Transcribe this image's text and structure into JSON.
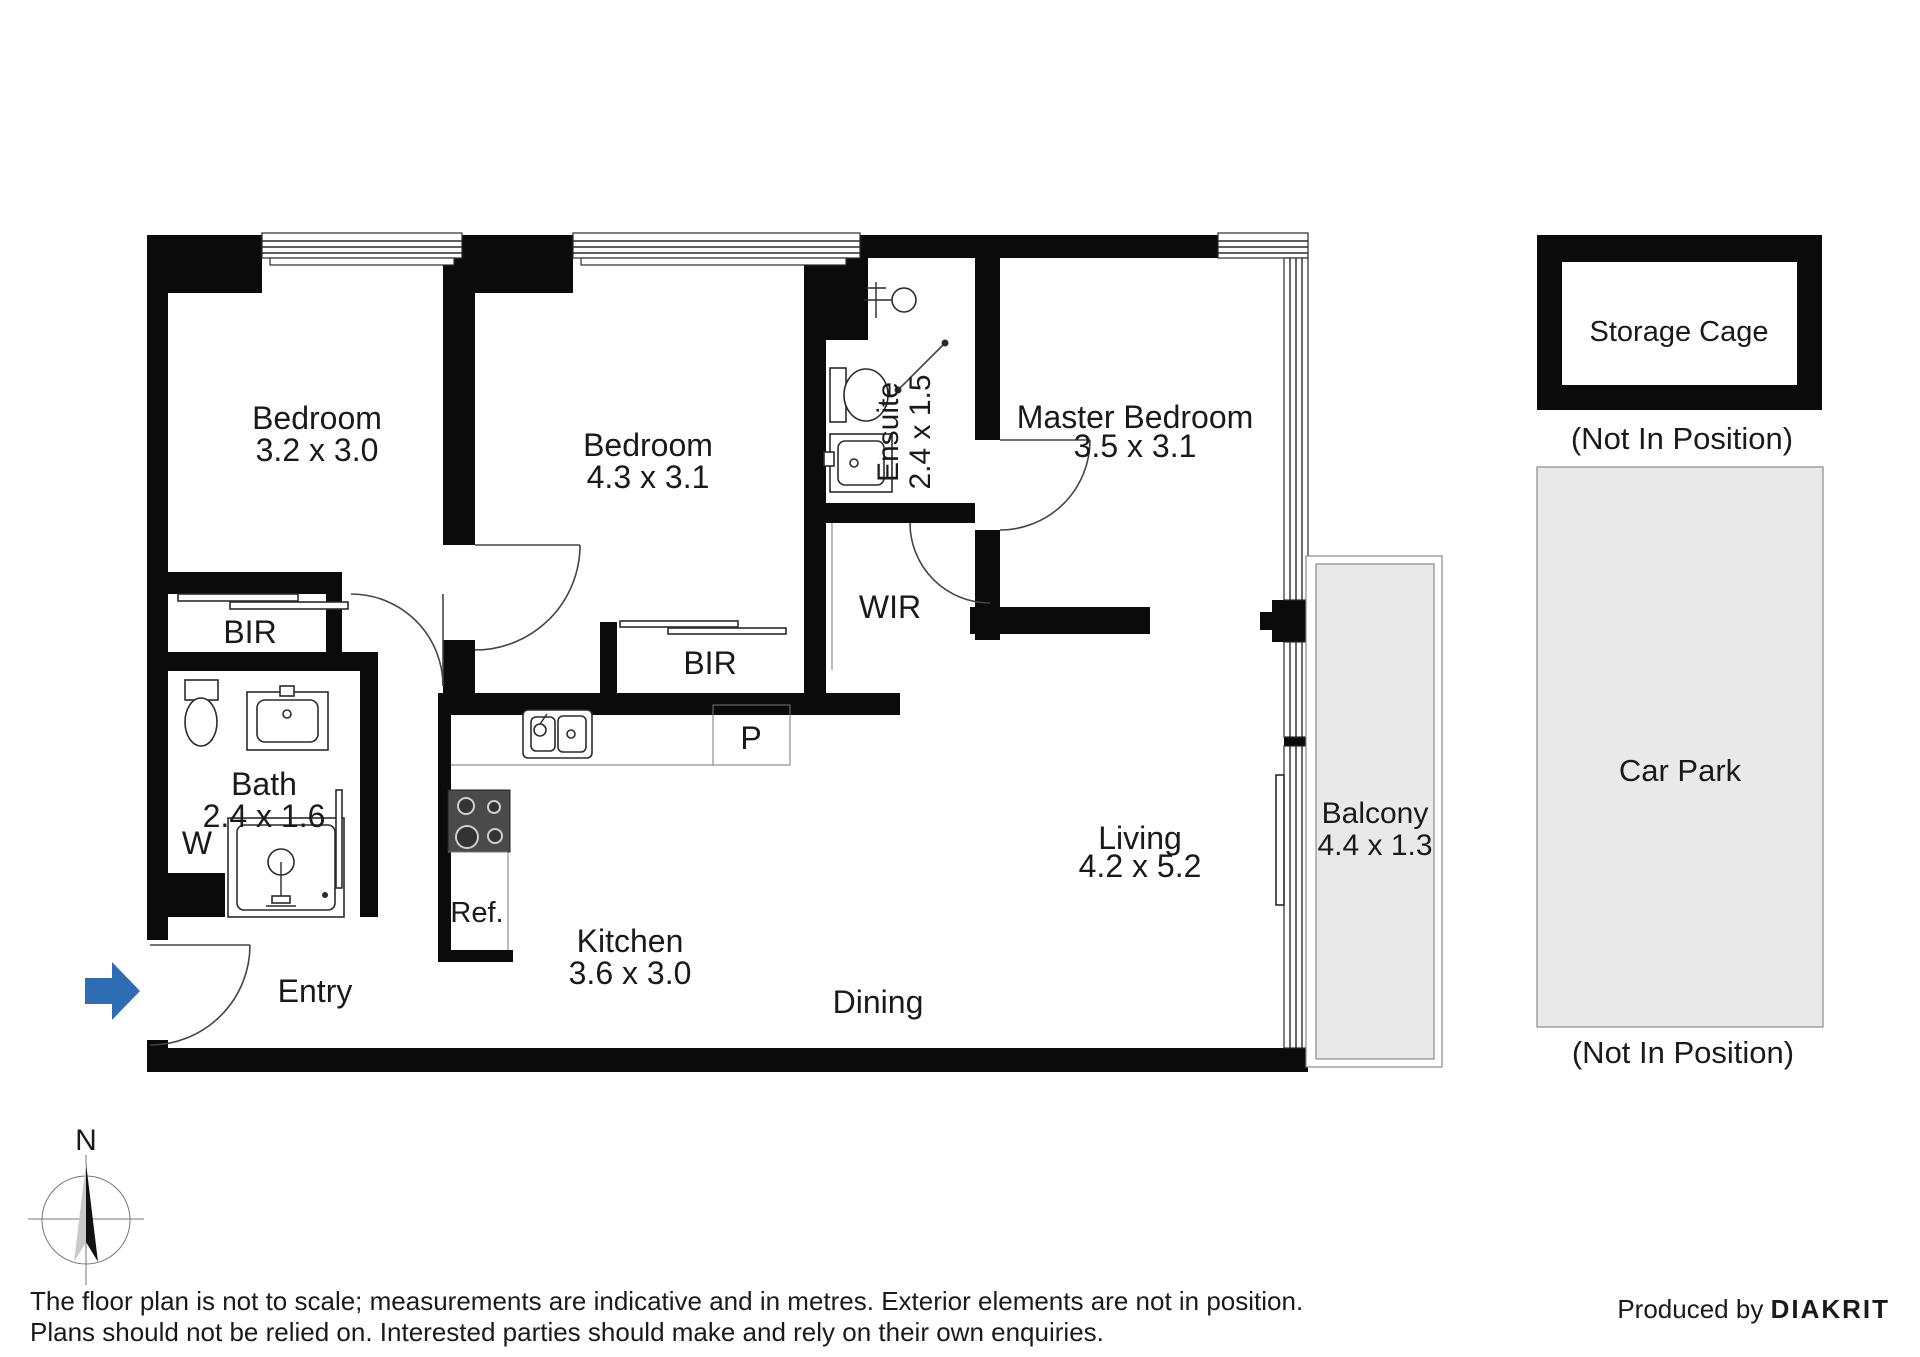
{
  "floorplan": {
    "rooms": {
      "bedroom1": {
        "name": "Bedroom",
        "dims": "3.2 x 3.0"
      },
      "bedroom2": {
        "name": "Bedroom",
        "dims": "4.3 x 3.1"
      },
      "master": {
        "name": "Master Bedroom",
        "dims": "3.5 x 3.1"
      },
      "ensuite": {
        "name": "Ensuite",
        "dims": "2.4 x 1.5"
      },
      "bath": {
        "name": "Bath",
        "dims": "2.4 x 1.6"
      },
      "kitchen": {
        "name": "Kitchen",
        "dims": "3.6 x 3.0"
      },
      "living": {
        "name": "Living",
        "dims": "4.2 x 5.2"
      },
      "balcony": {
        "name": "Balcony",
        "dims": "4.4 x 1.3"
      },
      "dining": {
        "name": "Dining"
      },
      "entry": {
        "name": "Entry"
      },
      "wir": {
        "name": "WIR"
      },
      "bir1": {
        "name": "BIR"
      },
      "bir2": {
        "name": "BIR"
      },
      "laundry": {
        "name": "W"
      },
      "pantry": {
        "name": "P"
      },
      "fridge": {
        "name": "Ref."
      }
    },
    "external": {
      "storage": {
        "name": "Storage Cage",
        "note": "(Not In Position)"
      },
      "carpark": {
        "name": "Car Park",
        "note": "(Not In Position)"
      }
    },
    "compass": {
      "label": "N"
    },
    "colors": {
      "wall": "#0b0b0b",
      "area_fill": "#e9e9e9",
      "entry_arrow": "#2e6db4"
    }
  },
  "footer": {
    "disclaimer_line1": "The floor plan is not to scale; measurements are indicative and in metres. Exterior elements are not in position.",
    "disclaimer_line2": "Plans should not be relied on. Interested parties should make and rely on their own enquiries.",
    "credit_prefix": "Produced by ",
    "credit_brand": "DIAKRIT"
  }
}
